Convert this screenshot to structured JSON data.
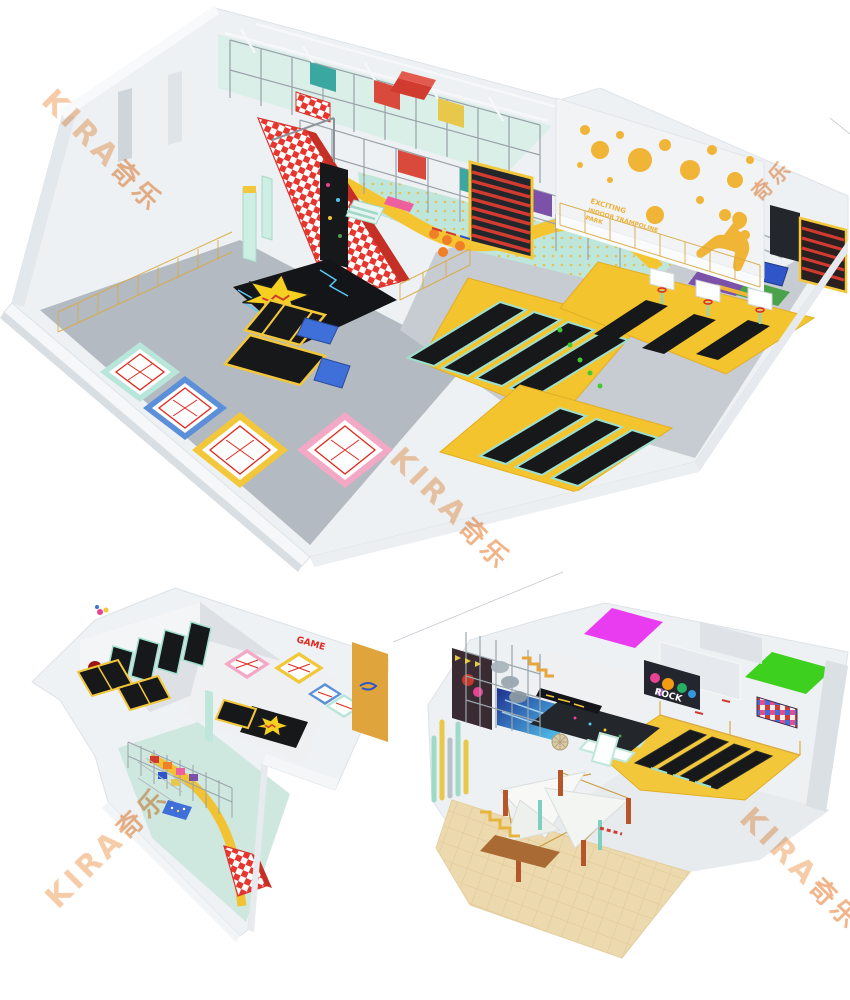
{
  "page": {
    "background": "#ffffff"
  },
  "watermark": {
    "text": "KIRA 奇乐",
    "latin": "KIRA",
    "cjk": "奇乐",
    "color_latin": "#f6c7a0",
    "color_cjk": "#f0ad7d",
    "instances": 5
  },
  "texts": {
    "wall_slogan_line1": "EXCITING",
    "wall_slogan_line2": "INDOOR TRAMPOLINE",
    "wall_slogan_line3": "PARK",
    "rock_graffiti": "ROCK",
    "game_graffiti": "GAME"
  },
  "colors": {
    "trampoline_yellow": "#f4c42e",
    "trampoline_black": "#17181a",
    "mint": "#bfe6da",
    "court_line_red": "#e0281e",
    "checker_red": "#e8352e",
    "magenta_room": "#e93cf0",
    "green_room": "#3ed01e",
    "wall_gray": "#eef1f4",
    "floor_gray": "#b6bdc4"
  }
}
